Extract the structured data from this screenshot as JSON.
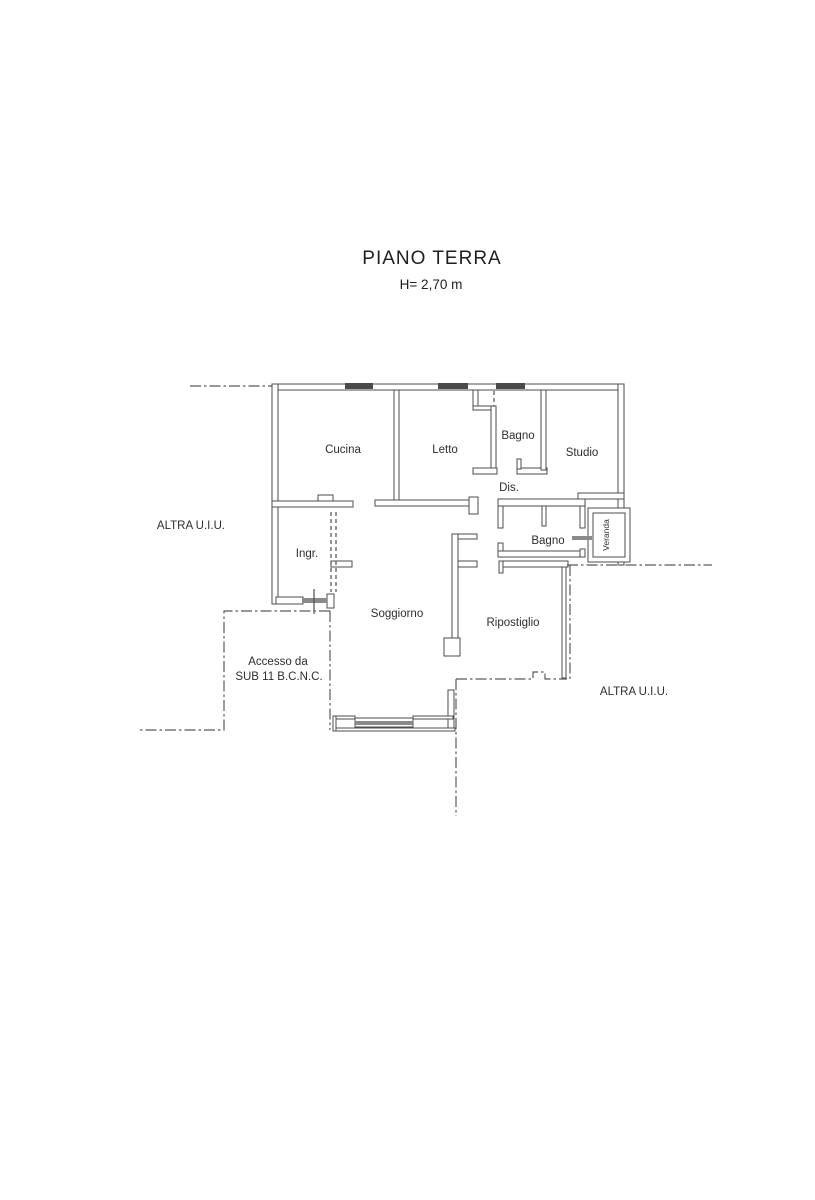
{
  "title": "PIANO TERRA",
  "subtitle": "H= 2,70 m",
  "rooms": {
    "cucina": "Cucina",
    "letto": "Letto",
    "bagno_top": "Bagno",
    "studio": "Studio",
    "dis": "Dis.",
    "bagno_bottom": "Bagno",
    "veranda": "Veranda",
    "ingresso": "Ingr.",
    "soggiorno": "Soggiorno",
    "ripostiglio": "Ripostiglio"
  },
  "annotations": {
    "altra_uiu_left": "ALTRA U.I.U.",
    "altra_uiu_right": "ALTRA U.I.U.",
    "accesso_line1": "Accesso da",
    "accesso_line2": "SUB 11 B.C.N.C."
  },
  "colors": {
    "background": "#ffffff",
    "wall_line": "#4d4d4d",
    "window_fill": "#4a4a4a",
    "boundary_line": "#5a5a5a",
    "text": "#2e2e2e"
  }
}
